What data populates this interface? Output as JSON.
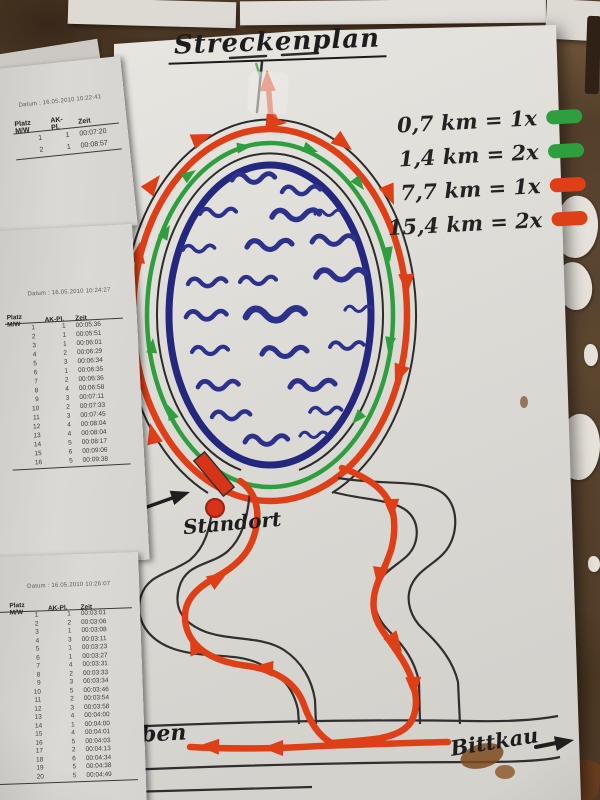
{
  "poster": {
    "title": "Streckenplan",
    "legend": {
      "items": [
        {
          "label": "0,7 km = 1x",
          "color": "#2f9e3f",
          "color_name": "green"
        },
        {
          "label": "1,4 km = 2x",
          "color": "#2f9e3f",
          "color_name": "green"
        },
        {
          "label": "7,7 km = 1x",
          "color": "#df3f16",
          "color_name": "red"
        },
        {
          "label": "15,4 km = 2x",
          "color": "#df3f16",
          "color_name": "red"
        }
      ]
    },
    "labels": {
      "standort": "Standort",
      "start_ziel_fragment_top": "t /",
      "start_ziel_fragment_bottom": "el",
      "place_bottom_left": "eben",
      "place_bottom_right": "Bittkau"
    },
    "colors": {
      "short_route_green": "#2f9e3f",
      "long_route_red": "#df3f16",
      "lake_blue": "#2c318c",
      "ink_black": "#2b2b2b",
      "paper": "#dfddd8"
    }
  },
  "result_sheets": [
    {
      "date_label": "Datum :",
      "date": "16.05.2010 10:22:41",
      "columns": [
        "Platz M/W",
        "AK-Pl.",
        "Zeit"
      ],
      "rows": [
        {
          "platz": "1",
          "ak": "1",
          "zeit": "00:07:20"
        },
        {
          "platz": "2",
          "ak": "1",
          "zeit": "00:08:57"
        }
      ]
    },
    {
      "date_label": "Datum :",
      "date": "16.05.2010 10:24:27",
      "columns": [
        "Platz M/W",
        "AK-Pl.",
        "Zeit"
      ],
      "rows": [
        {
          "platz": "1",
          "ak": "1",
          "zeit": "00:05:36"
        },
        {
          "platz": "2",
          "ak": "1",
          "zeit": "00:05:51"
        },
        {
          "platz": "3",
          "ak": "1",
          "zeit": "00:06:01"
        },
        {
          "platz": "4",
          "ak": "2",
          "zeit": "00:06:29"
        },
        {
          "platz": "5",
          "ak": "3",
          "zeit": "00:06:34"
        },
        {
          "platz": "6",
          "ak": "1",
          "zeit": "00:06:35"
        },
        {
          "platz": "7",
          "ak": "2",
          "zeit": "00:06:36"
        },
        {
          "platz": "8",
          "ak": "4",
          "zeit": "00:06:58"
        },
        {
          "platz": "9",
          "ak": "3",
          "zeit": "00:07:11"
        },
        {
          "platz": "10",
          "ak": "2",
          "zeit": "00:07:33"
        },
        {
          "platz": "11",
          "ak": "3",
          "zeit": "00:07:45"
        },
        {
          "platz": "12",
          "ak": "4",
          "zeit": "00:08:04"
        },
        {
          "platz": "13",
          "ak": "4",
          "zeit": "00:08:04"
        },
        {
          "platz": "14",
          "ak": "5",
          "zeit": "00:08:17"
        },
        {
          "platz": "15",
          "ak": "6",
          "zeit": "00:09:06"
        },
        {
          "platz": "16",
          "ak": "5",
          "zeit": "00:09:38"
        }
      ]
    },
    {
      "date_label": "Datum :",
      "date": "16.05.2010 10:26:07",
      "columns": [
        "Platz M/W",
        "AK-Pl.",
        "Zeit"
      ],
      "rows": [
        {
          "frag": "",
          "platz": "1",
          "ak": "1",
          "zeit": "00:03:01"
        },
        {
          "frag": "",
          "platz": "2",
          "ak": "2",
          "zeit": "00:03:06"
        },
        {
          "frag": "",
          "platz": "3",
          "ak": "1",
          "zeit": "00:03:08"
        },
        {
          "frag": "",
          "platz": "4",
          "ak": "3",
          "zeit": "00:03:11"
        },
        {
          "frag": "9",
          "platz": "5",
          "ak": "1",
          "zeit": "00:03:23"
        },
        {
          "frag": "1",
          "platz": "6",
          "ak": "1",
          "zeit": "00:03:27"
        },
        {
          "frag": "0",
          "platz": "7",
          "ak": "4",
          "zeit": "00:03:31"
        },
        {
          "frag": "8",
          "platz": "8",
          "ak": "2",
          "zeit": "00:03:33"
        },
        {
          "frag": "8",
          "platz": "9",
          "ak": "3",
          "zeit": "00:03:34"
        },
        {
          "frag": "10",
          "platz": "10",
          "ak": "5",
          "zeit": "00:03:46"
        },
        {
          "frag": "19",
          "platz": "11",
          "ak": "2",
          "zeit": "00:03:54"
        },
        {
          "frag": "99",
          "platz": "12",
          "ak": "3",
          "zeit": "00:03:58"
        },
        {
          "frag": "V8",
          "platz": "13",
          "ak": "4",
          "zeit": "00:04:00"
        },
        {
          "frag": "57",
          "platz": "14",
          "ak": "1",
          "zeit": "00:04:00"
        },
        {
          "frag": "V9",
          "platz": "15",
          "ak": "4",
          "zeit": "00:04:01"
        },
        {
          "frag": "",
          "platz": "16",
          "ak": "5",
          "zeit": "00:04:03"
        },
        {
          "frag": "V57",
          "platz": "17",
          "ak": "2",
          "zeit": "00:04:13"
        },
        {
          "frag": "",
          "platz": "18",
          "ak": "6",
          "zeit": "00:04:34"
        },
        {
          "frag": "57",
          "platz": "19",
          "ak": "5",
          "zeit": "00:04:38"
        },
        {
          "frag": "89",
          "platz": "20",
          "ak": "5",
          "zeit": "00:04:49"
        }
      ]
    }
  ]
}
